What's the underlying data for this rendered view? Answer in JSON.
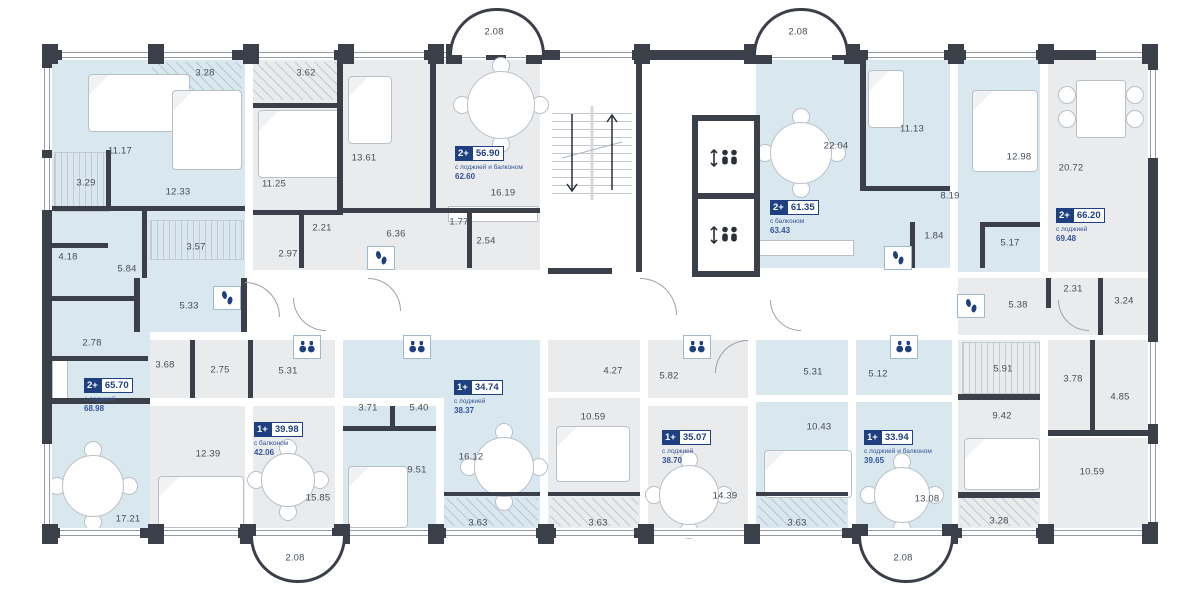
{
  "plan_title": "floor-plan",
  "colors": {
    "wall": "#3a3f4a",
    "blue_room": "#d9e7ee",
    "gray_room": "#eaebec",
    "white": "#ffffff",
    "navy": "#1e4080",
    "label": "#474e5a"
  },
  "apartments": [
    {
      "x": 84,
      "y": 378,
      "type": "2+",
      "area": "65.70",
      "sub": "с лоджией",
      "total": "68.98"
    },
    {
      "x": 455,
      "y": 146,
      "type": "2+",
      "area": "56.90",
      "sub": "с лоджией и балконом",
      "total": "62.60"
    },
    {
      "x": 770,
      "y": 200,
      "type": "2+",
      "area": "61.35",
      "sub": "с балконом",
      "total": "63.43"
    },
    {
      "x": 1056,
      "y": 208,
      "type": "2+",
      "area": "66.20",
      "sub": "с лоджией",
      "total": "69.48"
    },
    {
      "x": 254,
      "y": 422,
      "type": "1+",
      "area": "39.98",
      "sub": "с балконом",
      "total": "42.06"
    },
    {
      "x": 454,
      "y": 380,
      "type": "1+",
      "area": "34.74",
      "sub": "с лоджией",
      "total": "38.37"
    },
    {
      "x": 662,
      "y": 430,
      "type": "1+",
      "area": "35.07",
      "sub": "с лоджией",
      "total": "38.70"
    },
    {
      "x": 864,
      "y": 430,
      "type": "1+",
      "area": "33.94",
      "sub": "с лоджией и балконом",
      "total": "39.65"
    }
  ],
  "fills": [
    [
      52,
      60,
      193,
      272,
      "b"
    ],
    [
      52,
      332,
      98,
      196,
      "b"
    ],
    [
      253,
      60,
      287,
      210,
      "g"
    ],
    [
      548,
      60,
      200,
      272,
      "w"
    ],
    [
      756,
      60,
      194,
      208,
      "b"
    ],
    [
      958,
      60,
      82,
      212,
      "b"
    ],
    [
      1048,
      60,
      100,
      212,
      "g"
    ],
    [
      958,
      278,
      190,
      57,
      "g"
    ],
    [
      958,
      340,
      82,
      188,
      "g"
    ],
    [
      1048,
      340,
      100,
      90,
      "g"
    ],
    [
      1048,
      438,
      100,
      90,
      "g"
    ],
    [
      150,
      340,
      185,
      58,
      "g"
    ],
    [
      150,
      406,
      95,
      122,
      "g"
    ],
    [
      253,
      406,
      82,
      122,
      "g"
    ],
    [
      343,
      340,
      197,
      58,
      "b"
    ],
    [
      444,
      340,
      96,
      188,
      "b"
    ],
    [
      343,
      406,
      93,
      122,
      "b"
    ],
    [
      548,
      340,
      92,
      52,
      "g"
    ],
    [
      648,
      340,
      100,
      58,
      "g"
    ],
    [
      548,
      398,
      92,
      130,
      "g"
    ],
    [
      648,
      406,
      100,
      122,
      "g"
    ],
    [
      756,
      340,
      92,
      55,
      "b"
    ],
    [
      856,
      340,
      96,
      55,
      "b"
    ],
    [
      756,
      402,
      92,
      126,
      "b"
    ],
    [
      856,
      402,
      96,
      126,
      "b"
    ],
    [
      245,
      278,
      707,
      54,
      "w"
    ]
  ],
  "walls": [
    [
      52,
      206,
      193,
      5
    ],
    [
      106,
      150,
      5,
      58
    ],
    [
      142,
      211,
      5,
      67
    ],
    [
      52,
      243,
      56,
      5
    ],
    [
      52,
      296,
      88,
      5
    ],
    [
      52,
      356,
      96,
      5
    ],
    [
      134,
      278,
      6,
      54
    ],
    [
      52,
      398,
      98,
      6
    ],
    [
      253,
      103,
      90,
      5
    ],
    [
      337,
      60,
      6,
      150
    ],
    [
      299,
      212,
      5,
      56
    ],
    [
      253,
      210,
      90,
      5
    ],
    [
      430,
      60,
      6,
      148
    ],
    [
      343,
      208,
      197,
      5
    ],
    [
      467,
      212,
      5,
      56
    ],
    [
      636,
      60,
      6,
      212
    ],
    [
      548,
      268,
      64,
      6
    ],
    [
      860,
      60,
      6,
      128
    ],
    [
      860,
      186,
      90,
      5
    ],
    [
      985,
      222,
      55,
      5
    ],
    [
      980,
      222,
      5,
      46
    ],
    [
      910,
      222,
      5,
      46
    ],
    [
      1046,
      278,
      5,
      30
    ],
    [
      1098,
      278,
      5,
      57
    ],
    [
      958,
      394,
      82,
      6
    ],
    [
      958,
      492,
      82,
      6
    ],
    [
      1048,
      430,
      100,
      6
    ],
    [
      1090,
      340,
      5,
      90
    ],
    [
      190,
      340,
      5,
      58
    ],
    [
      248,
      340,
      5,
      58
    ],
    [
      343,
      426,
      93,
      5
    ],
    [
      390,
      406,
      5,
      24
    ],
    [
      241,
      278,
      6,
      54
    ],
    [
      444,
      492,
      96,
      4
    ],
    [
      548,
      492,
      92,
      4
    ],
    [
      756,
      492,
      92,
      4
    ]
  ],
  "windows": [
    [
      62,
      50,
      86,
      10,
      "h"
    ],
    [
      160,
      50,
      72,
      10,
      "h"
    ],
    [
      256,
      50,
      78,
      10,
      "h"
    ],
    [
      350,
      50,
      74,
      10,
      "h"
    ],
    [
      440,
      50,
      46,
      10,
      "h"
    ],
    [
      506,
      50,
      32,
      10,
      "h"
    ],
    [
      560,
      50,
      72,
      10,
      "h"
    ],
    [
      768,
      50,
      64,
      10,
      "h"
    ],
    [
      868,
      50,
      76,
      10,
      "h"
    ],
    [
      966,
      50,
      70,
      10,
      "h"
    ],
    [
      1096,
      50,
      50,
      10,
      "h"
    ],
    [
      60,
      528,
      80,
      10,
      "h"
    ],
    [
      158,
      528,
      80,
      10,
      "h"
    ],
    [
      256,
      528,
      76,
      10,
      "h"
    ],
    [
      350,
      528,
      82,
      10,
      "h"
    ],
    [
      446,
      528,
      90,
      10,
      "h"
    ],
    [
      556,
      528,
      78,
      10,
      "h"
    ],
    [
      652,
      528,
      92,
      10,
      "h"
    ],
    [
      760,
      528,
      82,
      10,
      "h"
    ],
    [
      858,
      528,
      86,
      10,
      "h"
    ],
    [
      962,
      528,
      74,
      10,
      "h"
    ],
    [
      1052,
      528,
      94,
      10,
      "h"
    ],
    [
      42,
      68,
      10,
      82,
      "v"
    ],
    [
      42,
      158,
      10,
      52,
      "v"
    ],
    [
      42,
      444,
      10,
      80,
      "v"
    ],
    [
      1148,
      70,
      10,
      88,
      "v"
    ],
    [
      1148,
      342,
      10,
      82,
      "v"
    ],
    [
      1148,
      444,
      10,
      78,
      "v"
    ]
  ],
  "pillars": [
    [
      42,
      44
    ],
    [
      148,
      44
    ],
    [
      243,
      44
    ],
    [
      338,
      44
    ],
    [
      428,
      44
    ],
    [
      446,
      44
    ],
    [
      526,
      44
    ],
    [
      634,
      44
    ],
    [
      744,
      44
    ],
    [
      756,
      44
    ],
    [
      844,
      44
    ],
    [
      948,
      44
    ],
    [
      1038,
      44
    ],
    [
      1142,
      44
    ],
    [
      42,
      524
    ],
    [
      148,
      524
    ],
    [
      240,
      524
    ],
    [
      334,
      524
    ],
    [
      428,
      524
    ],
    [
      538,
      524
    ],
    [
      638,
      524
    ],
    [
      744,
      524
    ],
    [
      852,
      524
    ],
    [
      942,
      524
    ],
    [
      1038,
      524
    ],
    [
      1142,
      524
    ]
  ],
  "balconies": [
    [
      449,
      8,
      90,
      44,
      "top",
      "2.08"
    ],
    [
      753,
      8,
      90,
      44,
      "top",
      "2.08"
    ],
    [
      250,
      536,
      90,
      44,
      "bottom",
      "2.08"
    ],
    [
      858,
      536,
      90,
      44,
      "bottom",
      "2.08"
    ]
  ],
  "room_labels": [
    [
      "3.28",
      205,
      73
    ],
    [
      "11.17",
      120,
      151
    ],
    [
      "3.29",
      86,
      183
    ],
    [
      "12.33",
      178,
      192
    ],
    [
      "3.57",
      196,
      247
    ],
    [
      "4.18",
      68,
      257
    ],
    [
      "5.84",
      127,
      269
    ],
    [
      "5.33",
      189,
      306
    ],
    [
      "2.78",
      92,
      343
    ],
    [
      "17.21",
      128,
      519
    ],
    [
      "3.62",
      306,
      73
    ],
    [
      "11.25",
      274,
      184
    ],
    [
      "2.21",
      322,
      228
    ],
    [
      "2.97",
      288,
      254
    ],
    [
      "13.61",
      364,
      158
    ],
    [
      "6.36",
      396,
      234
    ],
    [
      "1.77",
      459,
      222
    ],
    [
      "2.54",
      486,
      241
    ],
    [
      "16.19",
      503,
      193
    ],
    [
      "22.04",
      836,
      146
    ],
    [
      "11.13",
      912,
      129
    ],
    [
      "12.98",
      1019,
      157
    ],
    [
      "8.19",
      950,
      196
    ],
    [
      "1.84",
      934,
      236
    ],
    [
      "5.17",
      1010,
      243
    ],
    [
      "20.72",
      1071,
      168
    ],
    [
      "5.38",
      1018,
      305
    ],
    [
      "2.31",
      1073,
      289
    ],
    [
      "3.24",
      1124,
      301
    ],
    [
      "5.91",
      1003,
      369
    ],
    [
      "3.78",
      1073,
      379
    ],
    [
      "4.85",
      1120,
      397
    ],
    [
      "9.42",
      1002,
      416
    ],
    [
      "10.59",
      1092,
      472
    ],
    [
      "3.28",
      999,
      521
    ],
    [
      "3.68",
      165,
      365
    ],
    [
      "2.75",
      220,
      370
    ],
    [
      "5.31",
      288,
      371
    ],
    [
      "12.39",
      208,
      454
    ],
    [
      "15.85",
      318,
      498
    ],
    [
      "3.71",
      368,
      408
    ],
    [
      "5.40",
      419,
      408
    ],
    [
      "9.51",
      417,
      470
    ],
    [
      "16.12",
      471,
      457
    ],
    [
      "3.63",
      478,
      523
    ],
    [
      "4.27",
      613,
      371
    ],
    [
      "5.82",
      669,
      376
    ],
    [
      "10.59",
      593,
      417
    ],
    [
      "14.39",
      725,
      496
    ],
    [
      "3.63",
      598,
      523
    ],
    [
      "5.31",
      813,
      372
    ],
    [
      "5.12",
      878,
      374
    ],
    [
      "10.43",
      819,
      427
    ],
    [
      "13.08",
      927,
      499
    ],
    [
      "3.63",
      797,
      523
    ]
  ],
  "icons": [
    [
      "footprints-icon",
      227,
      298
    ],
    [
      "footprints-icon",
      381,
      258
    ],
    [
      "footprints-icon",
      898,
      258
    ],
    [
      "footprints-icon",
      971,
      306
    ],
    [
      "binoculars-icon",
      307,
      347
    ],
    [
      "binoculars-icon",
      417,
      347
    ],
    [
      "binoculars-icon",
      697,
      347
    ],
    [
      "binoculars-icon",
      904,
      347
    ]
  ],
  "elevators": [
    [
      692,
      115,
      56,
      74
    ],
    [
      692,
      193,
      56,
      72
    ]
  ],
  "stairs": [
    552,
    106,
    80,
    94
  ],
  "round_tables": [
    [
      92,
      485,
      30
    ],
    [
      287,
      479,
      26
    ],
    [
      500,
      104,
      33
    ],
    [
      800,
      152,
      30
    ],
    [
      503,
      466,
      29
    ],
    [
      688,
      494,
      29
    ],
    [
      901,
      494,
      27
    ]
  ],
  "dining_table": [
    1076,
    80,
    48,
    56
  ],
  "dining_chairs": [
    [
      1066,
      94
    ],
    [
      1066,
      118
    ],
    [
      1134,
      94
    ],
    [
      1134,
      118
    ]
  ],
  "beds": [
    [
      88,
      74,
      100,
      56
    ],
    [
      172,
      90,
      68,
      78
    ],
    [
      258,
      110,
      82,
      66
    ],
    [
      348,
      76,
      42,
      66
    ],
    [
      868,
      70,
      34,
      56
    ],
    [
      972,
      90,
      64,
      80
    ],
    [
      158,
      476,
      84,
      50
    ],
    [
      348,
      466,
      58,
      60
    ],
    [
      556,
      426,
      72,
      54
    ],
    [
      764,
      450,
      86,
      46
    ],
    [
      964,
      438,
      74,
      50
    ]
  ],
  "wardrobe_hatches": [
    [
      54,
      152,
      54,
      58
    ],
    [
      150,
      220,
      92,
      38
    ],
    [
      962,
      342,
      76,
      50
    ]
  ],
  "loggia_hatches": [
    [
      152,
      62,
      90,
      36
    ],
    [
      253,
      62,
      88,
      38
    ],
    [
      444,
      498,
      94,
      28
    ],
    [
      550,
      498,
      88,
      28
    ],
    [
      758,
      498,
      88,
      28
    ],
    [
      960,
      498,
      78,
      28
    ]
  ],
  "counters": [
    [
      448,
      206,
      88,
      14
    ],
    [
      756,
      240,
      96,
      14
    ],
    [
      52,
      360,
      14,
      40
    ]
  ],
  "door_arcs": [
    [
      245,
      282,
      34,
      "tr"
    ],
    [
      293,
      298,
      32,
      "bl"
    ],
    [
      368,
      278,
      32,
      "tr"
    ],
    [
      640,
      278,
      36,
      "tr"
    ],
    [
      770,
      300,
      30,
      "bl"
    ],
    [
      715,
      340,
      32,
      "tl"
    ],
    [
      1058,
      300,
      30,
      "bl"
    ]
  ]
}
